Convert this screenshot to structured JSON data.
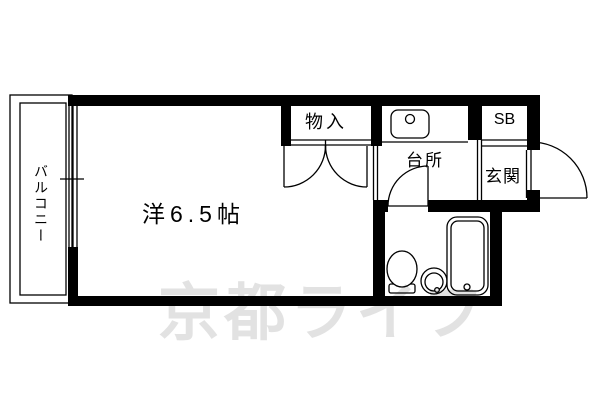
{
  "floor_plan": {
    "watermark_text": "京都ライフ",
    "labels": {
      "balcony": "バルコニー",
      "main_room": "洋6.5帖",
      "closet": "物入",
      "kitchen": "台所",
      "shoe_box": "SB",
      "entrance": "玄関"
    },
    "fixtures": [
      "kitchen-sink-icon",
      "toilet-icon",
      "wash-basin-icon",
      "bathtub-icon"
    ],
    "colors": {
      "line": "#000000",
      "background": "#ffffff",
      "watermark": "#e2e2e2"
    }
  }
}
